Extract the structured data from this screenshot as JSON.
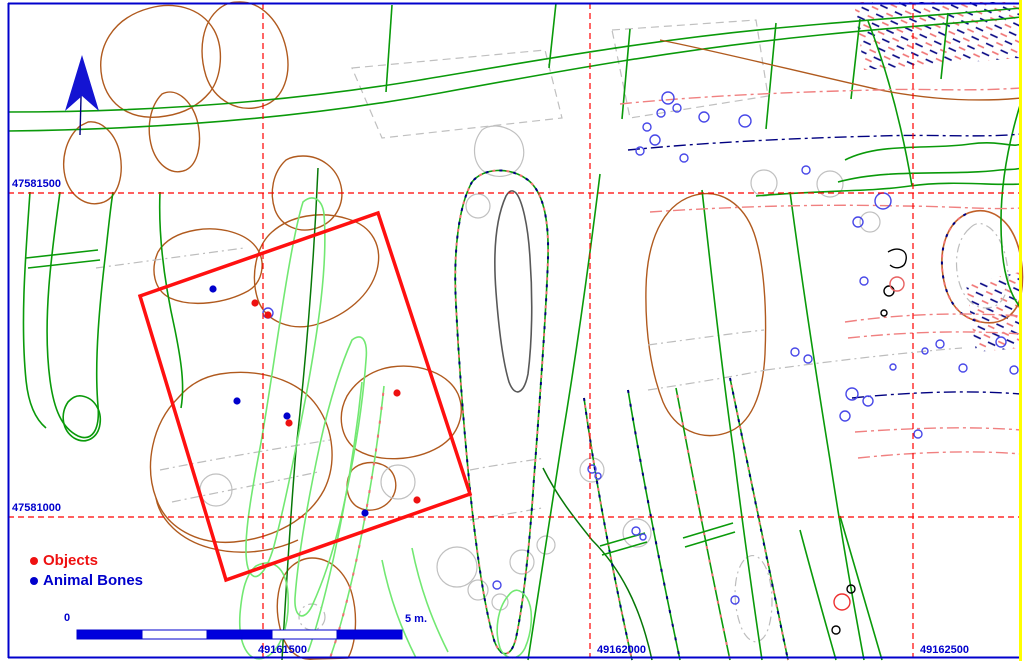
{
  "map": {
    "kind": "archaeological excavation plan",
    "frame": {
      "border_color": "#0000cc",
      "right_edge_color": "#ffff00"
    },
    "grid": {
      "line_color": "#ff0000",
      "label_color": "#0000cc",
      "horizontal": [
        {
          "label": "47581500",
          "y": 193
        },
        {
          "label": "47581000",
          "y": 517
        }
      ],
      "vertical": [
        {
          "label": "49161500",
          "x": 263
        },
        {
          "label": "49162000",
          "x": 590
        },
        {
          "label": "49162500",
          "x": 913
        }
      ]
    },
    "excavation_square": {
      "color": "#ff1010",
      "corners": [
        [
          140,
          296
        ],
        [
          378,
          213
        ],
        [
          470,
          494
        ],
        [
          226,
          580
        ]
      ]
    },
    "points": {
      "objects": {
        "label": "Objects",
        "color": "#ee1111",
        "coords": [
          [
            255,
            303
          ],
          [
            268,
            315
          ],
          [
            397,
            393
          ],
          [
            289,
            423
          ],
          [
            417,
            500
          ]
        ]
      },
      "animal_bones": {
        "label": "Animal Bones",
        "color": "#0000cc",
        "coords": [
          [
            213,
            289
          ],
          [
            237,
            401
          ],
          [
            287,
            416
          ],
          [
            365,
            513
          ]
        ]
      }
    },
    "north_arrow": {
      "icon": "north-arrow-icon",
      "color": "#1414d2"
    },
    "scale_bar": {
      "zero_label": "0",
      "end_label": "5 m.",
      "segments": 5,
      "x": 77,
      "y": 630,
      "segment_px": 65,
      "height": 9,
      "fill_color": "#0000dd",
      "alt_color": "#ffffff",
      "outline_color": "#0000cc"
    }
  },
  "legend": {
    "items": [
      {
        "label": "Objects",
        "color": "#ee1111",
        "marker": "dot-icon"
      },
      {
        "label": "Animal Bones",
        "color": "#0000cc",
        "marker": "dot-icon"
      }
    ]
  },
  "palette": {
    "field_green": "#0a9a0a",
    "light_green": "#72e872",
    "dark_green": "#077807",
    "feature_brown": "#b05a1e",
    "hatch_navy": "#000080",
    "hatch_red": "#f07070",
    "gray": "#bdbdbd",
    "dark_gray": "#585858",
    "stone_blue": "#4848e8"
  }
}
